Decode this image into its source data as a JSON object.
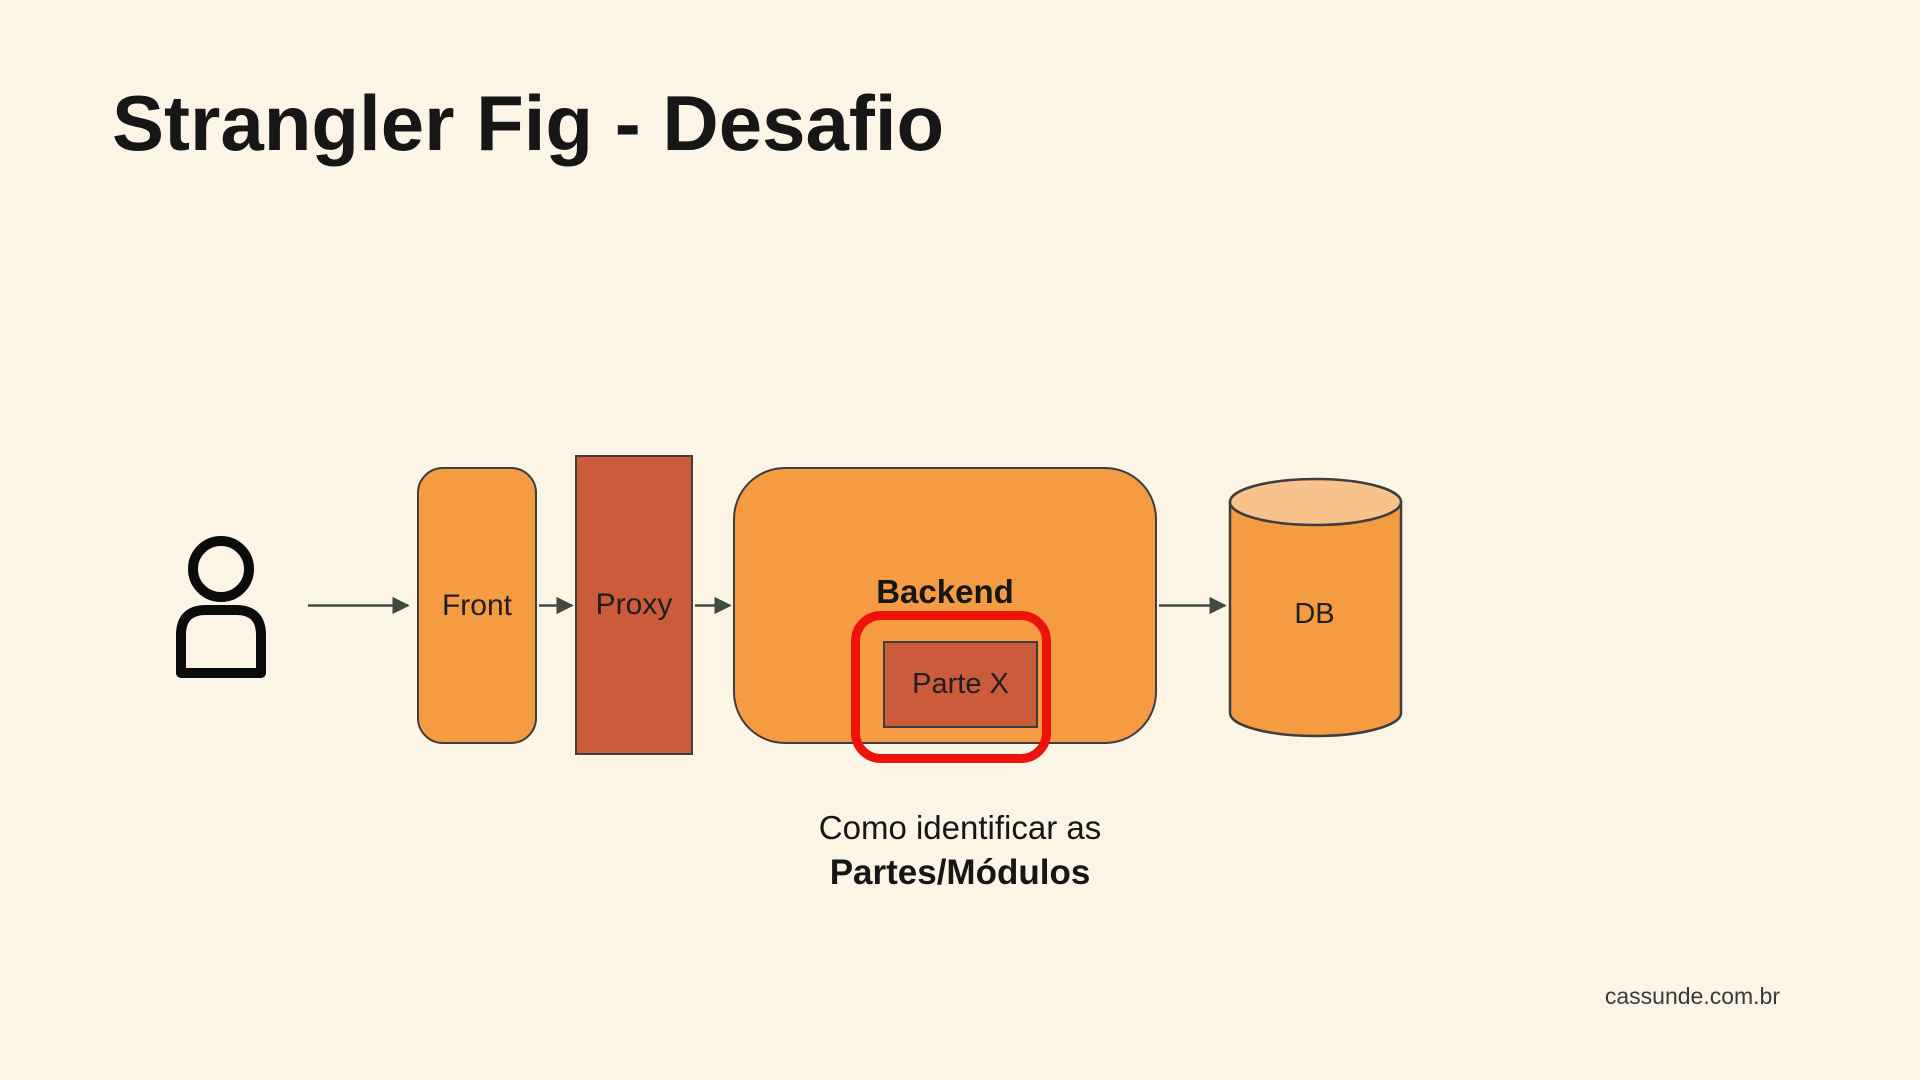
{
  "slide": {
    "title": "Strangler Fig - Desafio",
    "caption_line1": "Como identificar as",
    "caption_line2": "Partes/Módulos",
    "footer": "cassunde.com.br"
  },
  "diagram": {
    "nodes": {
      "front": "Front",
      "proxy": "Proxy",
      "backend": "Backend",
      "parte_x": "Parte X",
      "db": "DB"
    },
    "icons": {
      "user": "person-icon",
      "database": "cylinder-icon",
      "flow": "arrow-right-icon"
    },
    "flow": [
      "User",
      "Front",
      "Proxy",
      "Backend",
      "DB"
    ],
    "highlight": "Parte X module highlighted with red rounded outline"
  },
  "colors": {
    "background": "#FCF4E5",
    "title_text": "#161616",
    "orange_fill": "#F59B42",
    "deep_orange_fill": "#CC5B3B",
    "db_top_fill": "#F8C28C",
    "node_border": "#3E3E3E",
    "arrow": "#404A41",
    "highlight_red": "#EC130C",
    "label_text": "#1F1F1F",
    "footer_text": "#3A3A3A",
    "icon_black": "#0B0B0B"
  }
}
